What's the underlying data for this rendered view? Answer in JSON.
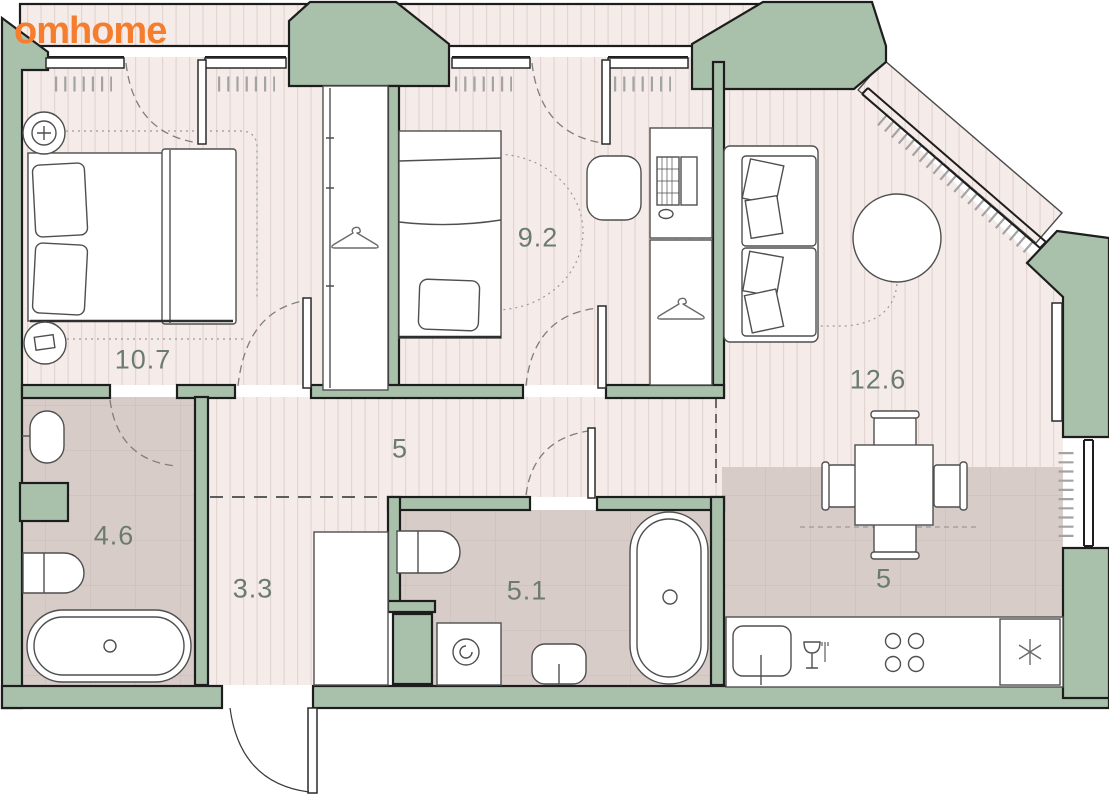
{
  "brand": {
    "logo_text": "omhome"
  },
  "floorplan": {
    "rooms": [
      {
        "name": "bedroom",
        "area_label": "10.7"
      },
      {
        "name": "bedroom-2",
        "area_label": "9.2"
      },
      {
        "name": "living-room",
        "area_label": "12.6"
      },
      {
        "name": "corridor",
        "area_label": "5"
      },
      {
        "name": "bathroom",
        "area_label": "4.6"
      },
      {
        "name": "hallway",
        "area_label": "3.3"
      },
      {
        "name": "bathroom-2",
        "area_label": "5.1"
      },
      {
        "name": "kitchen",
        "area_label": "5"
      }
    ],
    "icons": [
      "hanger-icon",
      "lamp-plus-icon",
      "spiral-drum-icon",
      "wine-glass-icon",
      "snowflake-icon",
      "burner-icon"
    ],
    "colors": {
      "wall": "#a9c0ab",
      "wall_outline": "#1d1d1d",
      "floor": "#f5ece9",
      "floor_stripe": "#e2d5d2",
      "tile": "#d8ccc8",
      "tile_grid": "#c9bcb8",
      "balcony": "#f3eae7",
      "logo": "#f57e2e",
      "label": "#6b7b71",
      "furniture_line": "#4f4f4f"
    }
  }
}
